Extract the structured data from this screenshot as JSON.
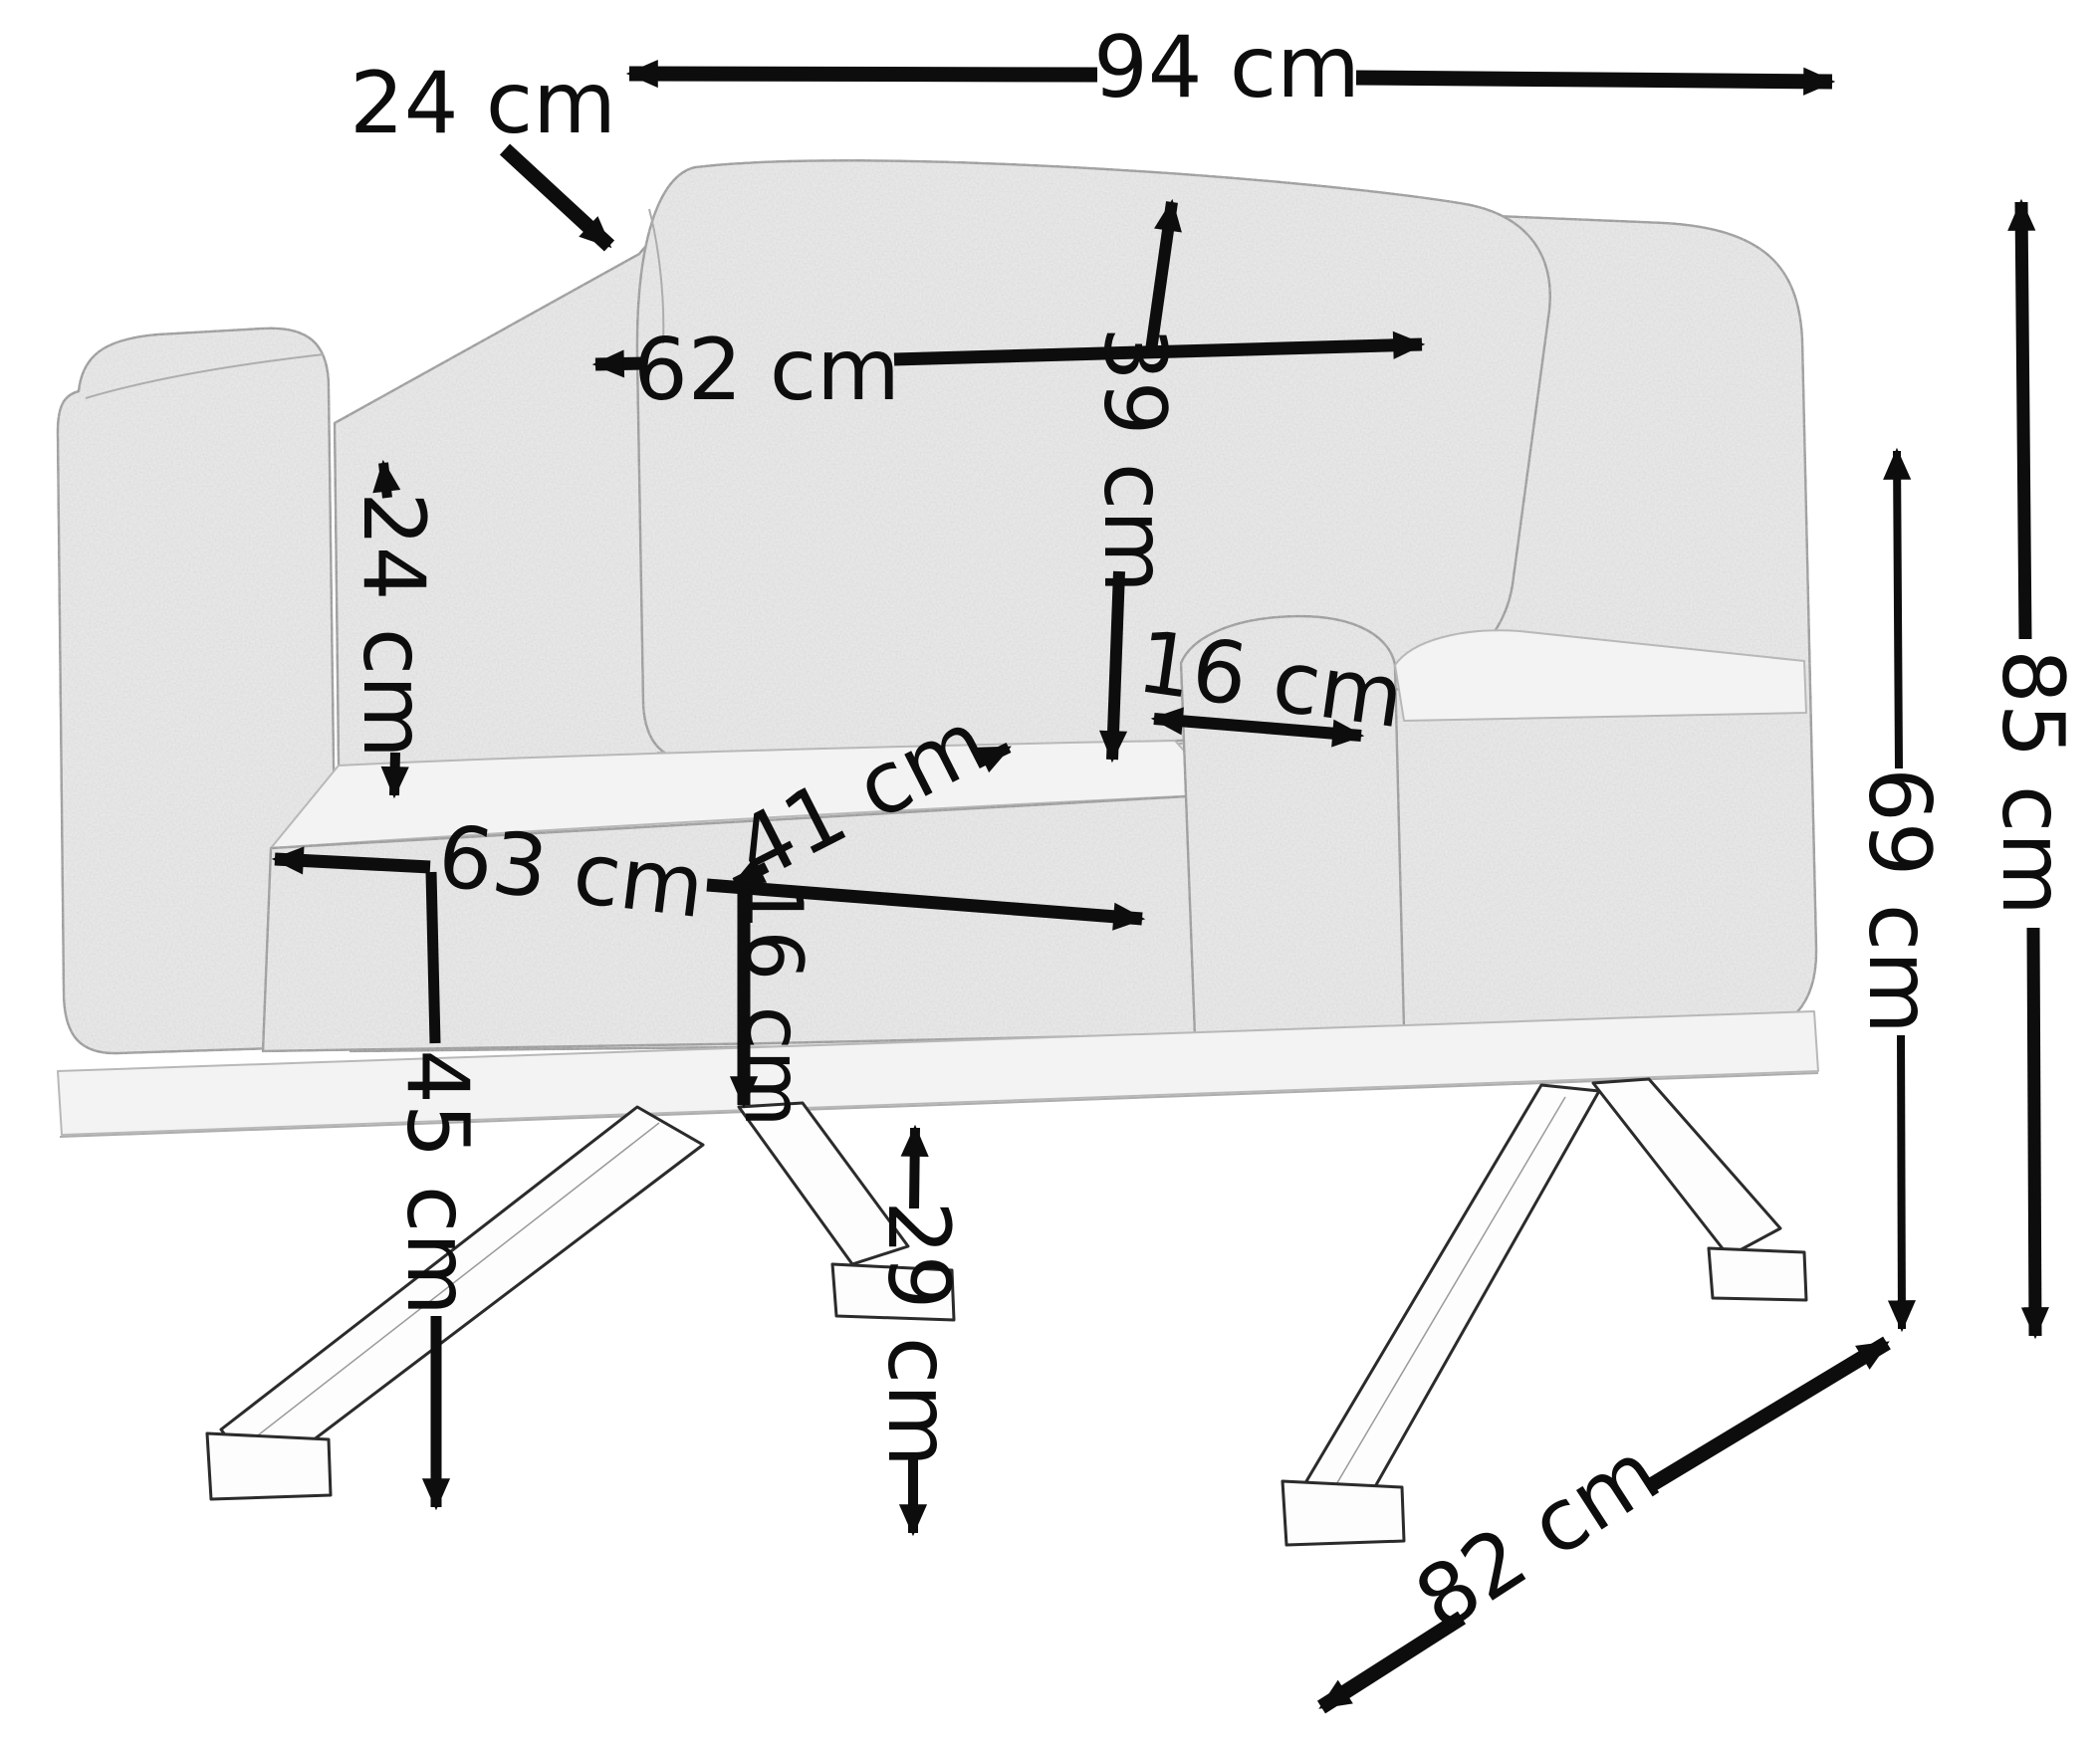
{
  "diagram": {
    "type": "furniture-dimension-diagram",
    "subject": "upholstered armchair on metal cross legs",
    "unit": "cm",
    "annotation_color": "#0d0d0d",
    "background_color": "#ffffff",
    "labels": {
      "overall_width": "94 cm",
      "back_cushion_thickness": "24 cm",
      "back_cushion_width": "62 cm",
      "back_cushion_height": "39 cm",
      "armrest_height_above_seat": "24 cm",
      "armrest_width": "16 cm",
      "seat_width": "63 cm",
      "seat_depth": "41 cm",
      "seat_cushion_thickness": "16 cm",
      "seat_height": "45 cm",
      "underframe_clearance": "29 cm",
      "armrest_top_height": "69 cm",
      "overall_height": "85 cm",
      "overall_depth": "82 cm"
    }
  }
}
